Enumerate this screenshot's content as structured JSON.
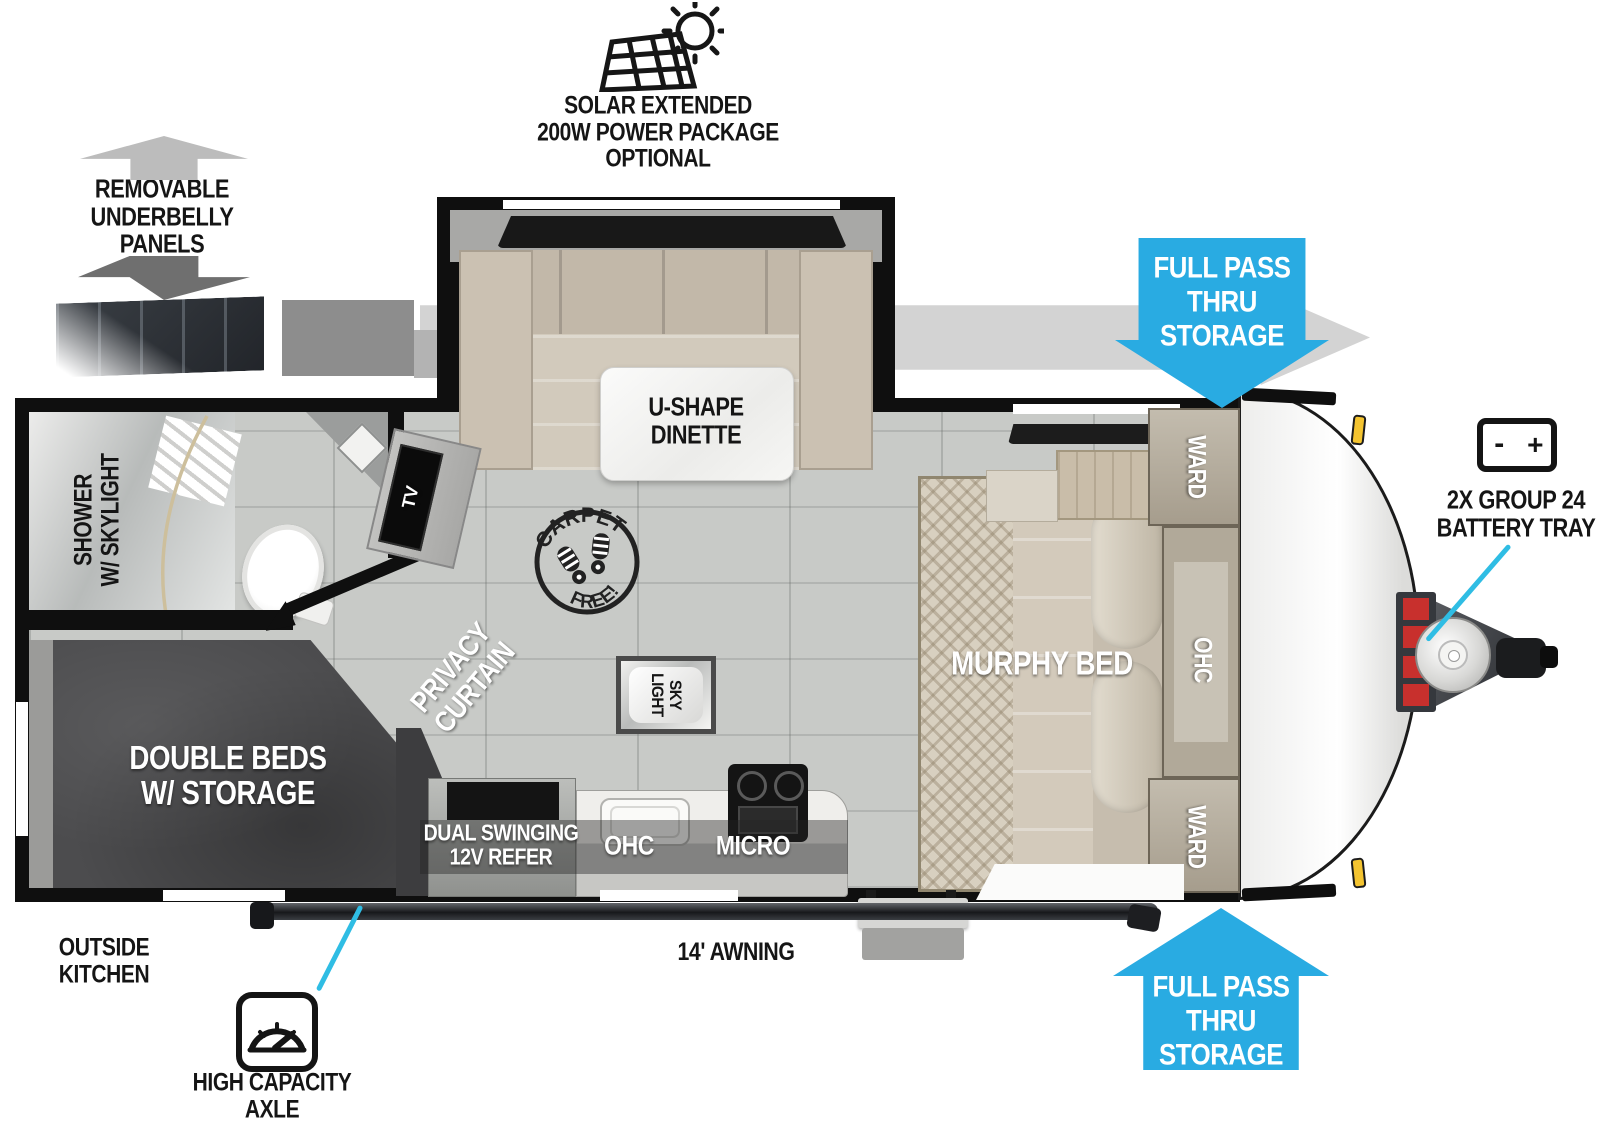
{
  "colors": {
    "arrow_blue": "#29abe2",
    "callout_cyan": "#2fbde4",
    "gray_arrow": "#d3d3d3",
    "panels_box_gray": "#8d8d8d",
    "bed_dark": "#4c4c4e",
    "floor_gray": "#c8cac7",
    "wall_black": "#0f0f0f"
  },
  "labels": {
    "solar": {
      "line1": "SOLAR EXTENDED",
      "line2": "200W POWER PACKAGE",
      "line3": "OPTIONAL"
    },
    "underbelly": {
      "line1": "REMOVABLE",
      "line2": "UNDERBELLY",
      "line3": "PANELS"
    },
    "panels_repeat": {
      "line1": "PANELS",
      "line2": "REPEAT"
    },
    "pass_thru_top": {
      "line1": "FULL PASS",
      "line2": "THRU",
      "line3": "STORAGE"
    },
    "pass_thru_bottom": {
      "line1": "FULL PASS",
      "line2": "THRU",
      "line3": "STORAGE"
    },
    "battery": {
      "minus": "-",
      "plus": "+",
      "line1": "2X GROUP 24",
      "line2": "BATTERY TRAY"
    },
    "axle": {
      "line1": "HIGH CAPACITY",
      "line2": "AXLE"
    },
    "outside_kitchen": {
      "line1": "OUTSIDE",
      "line2": "KITCHEN"
    },
    "awning": "14' AWNING"
  },
  "rooms": {
    "dinette": {
      "line1": "U-SHAPE",
      "line2": "DINETTE"
    },
    "murphy_bed": {
      "label": "MURPHY BED"
    },
    "ward_front_top": {
      "label": "WARD"
    },
    "ward_front_bottom": {
      "label": "WARD"
    },
    "ohc_front": {
      "label": "OHC"
    },
    "shower": {
      "line1": "SHOWER",
      "line2": "W/ SKYLIGHT"
    },
    "double_beds": {
      "line1": "DOUBLE BEDS",
      "line2": "W/ STORAGE"
    },
    "privacy_curtain": {
      "line1": "PRIVACY",
      "line2": "CURTAIN"
    },
    "tv": {
      "label": "TV"
    },
    "refer": {
      "line1": "DUAL SWINGING",
      "line2": "12V REFER"
    },
    "kitchen_ohc": {
      "label": "OHC"
    },
    "micro": {
      "label": "MICRO"
    },
    "skylight": {
      "line1": "SKY",
      "line2": "LIGHT"
    },
    "carpet_free": {
      "top": "CARPET",
      "bottom": "FREE!"
    }
  }
}
